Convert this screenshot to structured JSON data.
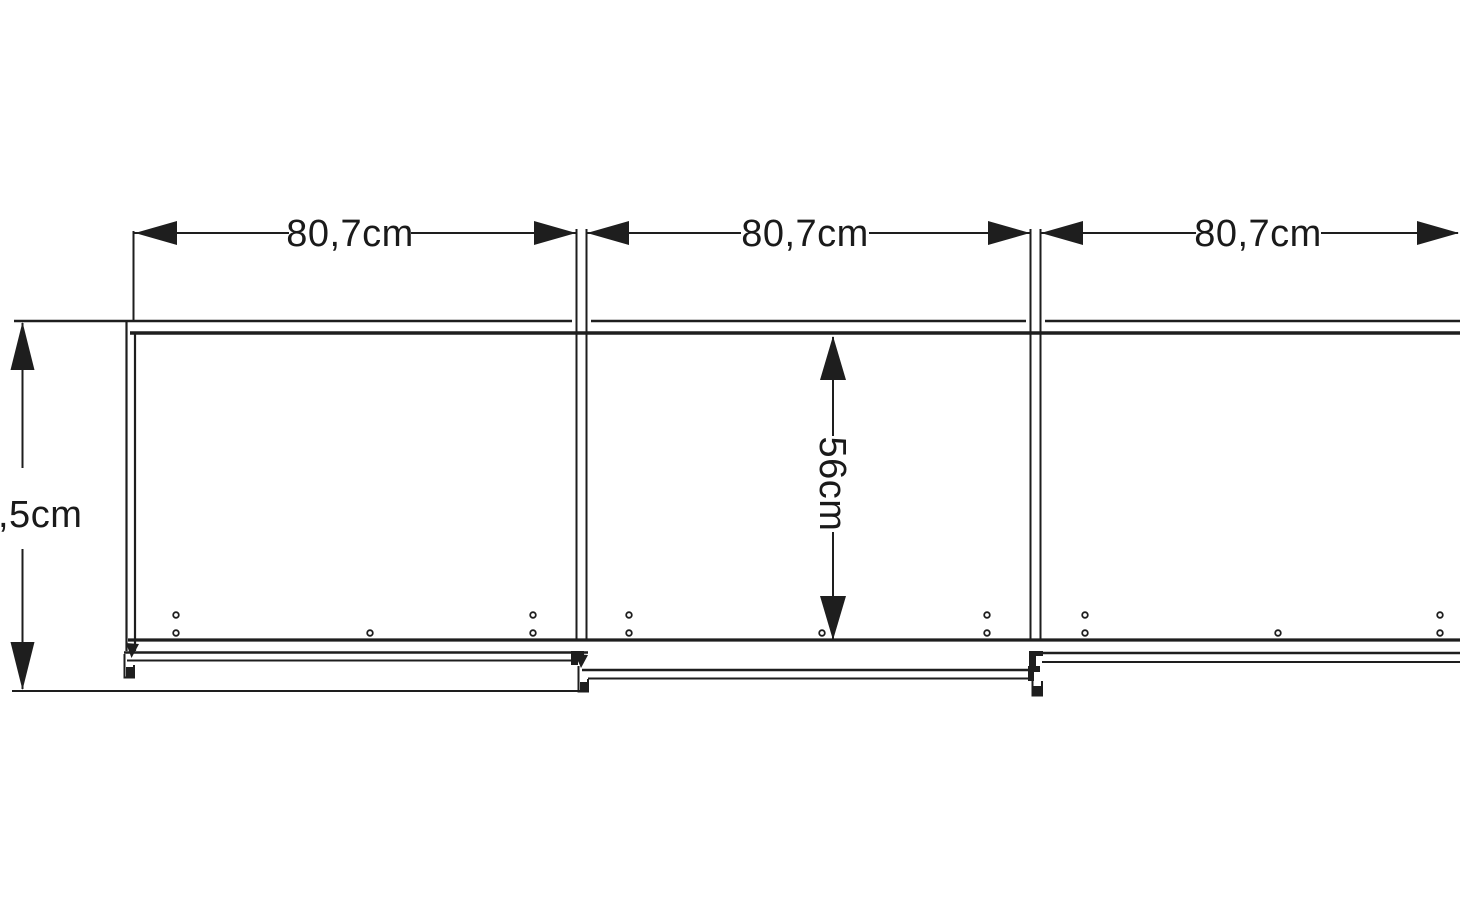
{
  "colors": {
    "background": "#ffffff",
    "line": "#1e1e1e",
    "text": "#1a1a1a"
  },
  "dimension_labels": {
    "widths": [
      {
        "label": "80,7cm"
      },
      {
        "label": "80,7cm"
      },
      {
        "label": "80,7cm"
      }
    ],
    "inner_height": {
      "label": "56cm"
    },
    "height_partial": {
      "label": ",5cm"
    }
  }
}
